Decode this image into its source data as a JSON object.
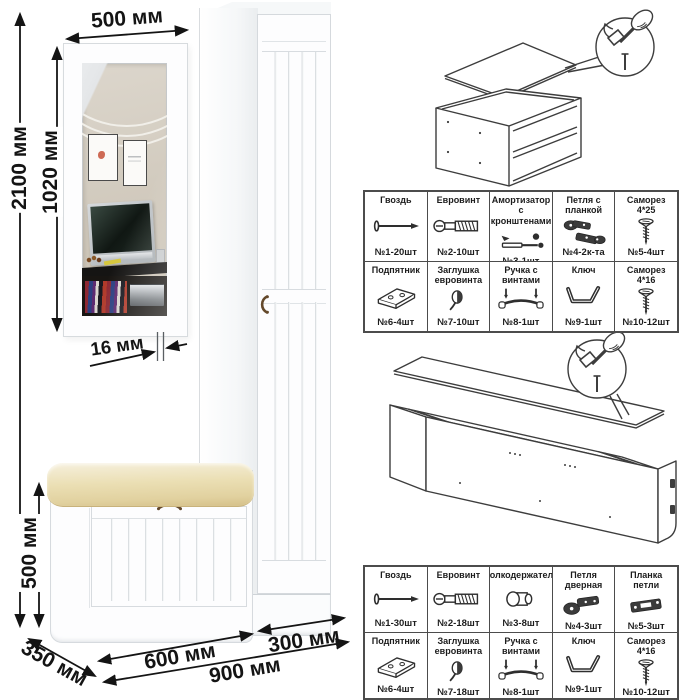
{
  "title": "Прихожая — схема размеров и фурнитура",
  "colors": {
    "cushion": "#ebdfb4",
    "handle": "#64492b",
    "line": "#141414",
    "table_border": "#4c4c4c"
  },
  "labels": {
    "dim_total_height": "2100 мм",
    "dim_mirror_width": "500 мм",
    "dim_mirror_height": "1020 мм",
    "dim_thickness": "16 мм",
    "dim_bench_height": "500 мм",
    "dim_bench_depth": "350 мм",
    "dim_bench_width": "600 мм",
    "dim_total_width": "900 мм",
    "dim_wardrobe_width": "300 мм"
  },
  "hardware_tables": [
    {
      "cells": [
        {
          "name": "Гвоздь",
          "qty": "№1-20шт",
          "icon": "#sym-nail"
        },
        {
          "name": "Евровинт",
          "qty": "№2-10шт",
          "icon": "#sym-euroscrew"
        },
        {
          "name": "Амортизатор с кронштенами",
          "qty": "№3-1шт",
          "icon": "#sym-strut"
        },
        {
          "name": "Петля с планкой",
          "qty": "№4-2к-та",
          "icon": "#sym-hingeplate"
        },
        {
          "name": "Саморез 4*25",
          "qty": "№5-4шт",
          "icon": "#sym-screw"
        },
        {
          "name": "Подпятник",
          "qty": "№6-4шт",
          "icon": "#sym-footplate"
        },
        {
          "name": "Заглушка евровинта",
          "qty": "№7-10шт",
          "icon": "#sym-cap"
        },
        {
          "name": "Ручка с винтами",
          "qty": "№8-1шт",
          "icon": "#sym-handle"
        },
        {
          "name": "Ключ",
          "qty": "№9-1шт",
          "icon": "#sym-hexkey"
        },
        {
          "name": "Саморез 4*16",
          "qty": "№10-12шт",
          "icon": "#sym-screw"
        }
      ]
    },
    {
      "cells": [
        {
          "name": "Гвоздь",
          "qty": "№1-30шт",
          "icon": "#sym-nail"
        },
        {
          "name": "Евровинт",
          "qty": "№2-18шт",
          "icon": "#sym-euroscrew"
        },
        {
          "name": "Полкодержатель",
          "qty": "№3-8шт",
          "icon": "#sym-shelfpin"
        },
        {
          "name": "Петля дверная",
          "qty": "№4-3шт",
          "icon": "#sym-doorhinge"
        },
        {
          "name": "Планка петли",
          "qty": "№5-3шт",
          "icon": "#sym-hingebar"
        },
        {
          "name": "Подпятник",
          "qty": "№6-4шт",
          "icon": "#sym-footplate"
        },
        {
          "name": "Заглушка евровинта",
          "qty": "№7-18шт",
          "icon": "#sym-cap"
        },
        {
          "name": "Ручка с винтами",
          "qty": "№8-1шт",
          "icon": "#sym-handle"
        },
        {
          "name": "Ключ",
          "qty": "№9-1шт",
          "icon": "#sym-hexkey"
        },
        {
          "name": "Саморез 4*16",
          "qty": "№10-12шт",
          "icon": "#sym-screw"
        }
      ]
    }
  ]
}
